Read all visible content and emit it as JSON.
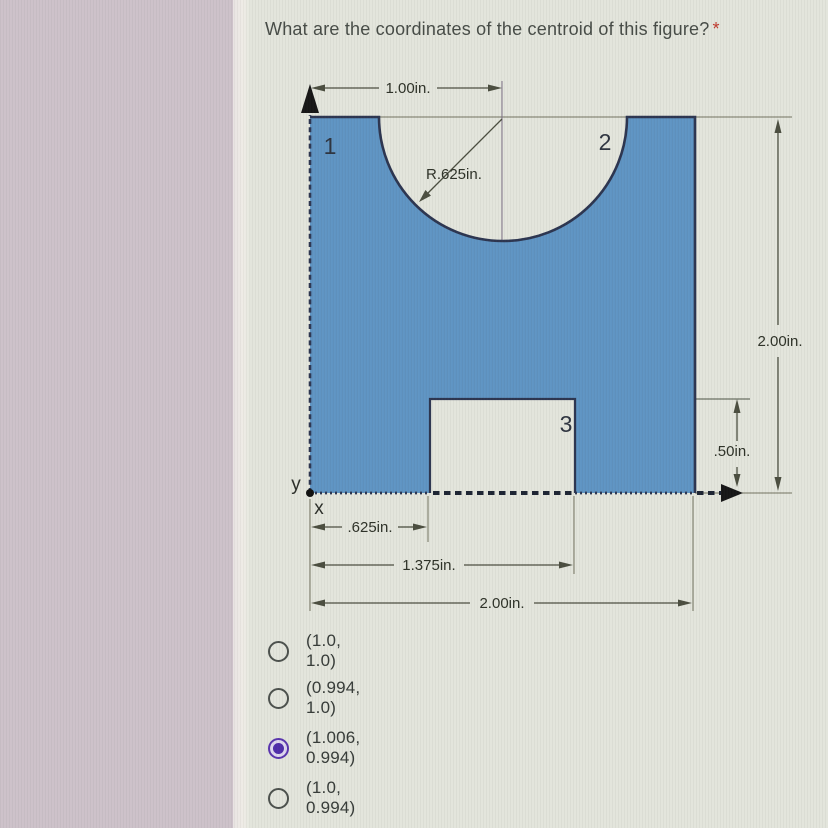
{
  "question": {
    "title": "What are the coordinates of the centroid of this figure?",
    "required_marker": "*"
  },
  "figure": {
    "region_labels": {
      "r1": "1",
      "r2": "2",
      "r3": "3"
    },
    "axes": {
      "x": "x",
      "y": "y"
    },
    "dims": {
      "top_width": "1.00in.",
      "radius": "R.625in.",
      "right_height": "2.00in.",
      "notch_height": ".50in.",
      "notch_left": ".625in.",
      "notch_right": "1.375in.",
      "bottom_width": "2.00in."
    },
    "colors": {
      "shape_fill": "#5f94c3",
      "shape_outline": "#2c3550",
      "dimension_line": "#4b4e40"
    }
  },
  "options": [
    {
      "label": "(1.0, 1.0)",
      "selected": false
    },
    {
      "label": "(0.994, 1.0)",
      "selected": false
    },
    {
      "label": "(1.006, 0.994)",
      "selected": true
    },
    {
      "label": "(1.0, 0.994)",
      "selected": false
    }
  ],
  "colors": {
    "selected_radio": "#5a35ae"
  }
}
